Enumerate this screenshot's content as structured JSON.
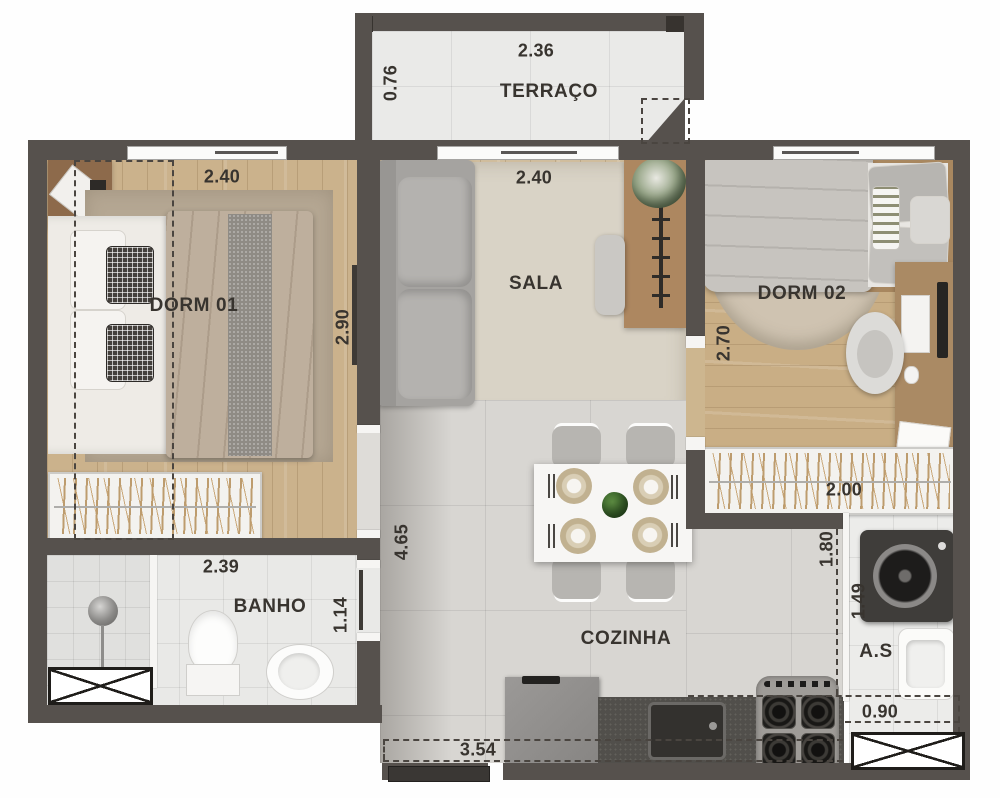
{
  "meta": {
    "type": "apartment-floor-plan",
    "language": "pt-BR",
    "view": "top-down-furnished"
  },
  "rooms": {
    "terraco": {
      "label": "TERRAÇO",
      "dim_width": "2.36",
      "dim_depth": "0.76"
    },
    "dorm01": {
      "label": "DORM 01",
      "dim_width": "2.40",
      "dim_depth": "2.90"
    },
    "sala": {
      "label": "SALA",
      "dim_width": "2.40"
    },
    "dorm02": {
      "label": "DORM 02",
      "dim_depth": "2.70",
      "dim_wardrobe": "2.00"
    },
    "banho": {
      "label": "BANHO",
      "dim_width": "2.39",
      "dim_depth": "1.14"
    },
    "cozinha": {
      "label": "COZINHA",
      "dim_depth": "4.65",
      "dim_width": "3.54"
    },
    "area_servico": {
      "label": "A.S",
      "dim_depth": "1.80",
      "dim_mid": "1.49",
      "dim_width": "0.90"
    }
  },
  "colors": {
    "wall": "#56514d",
    "wood_floor": "#cbb28c",
    "tile_light": "#e9e9e7",
    "tile_kitchen": "#d8d6d2",
    "rug": "#d9d3c6",
    "text": "#38342f",
    "plant_green": "#3c682c",
    "counter_granite": "#514f4b"
  }
}
